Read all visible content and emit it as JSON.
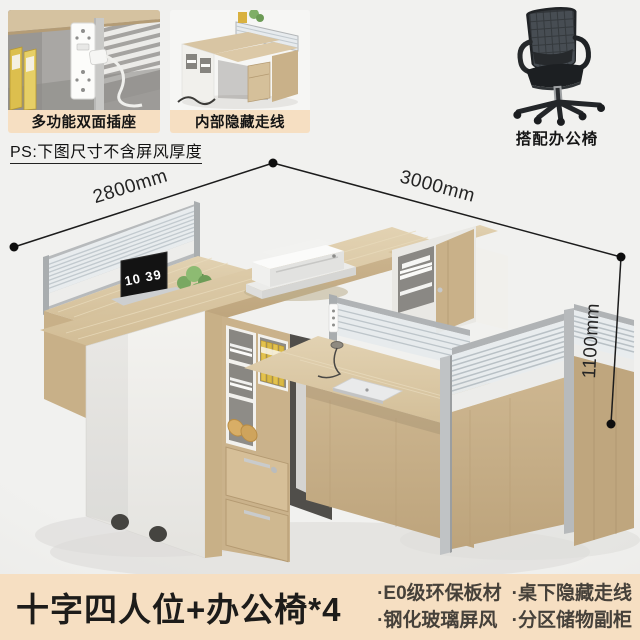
{
  "header": {
    "thumbnails": [
      {
        "label": "多功能双面插座"
      },
      {
        "label": "内部隐藏走线"
      }
    ],
    "chair_label": "搭配办公椅",
    "note": "PS:下图尺寸不含屏风厚度"
  },
  "diagram": {
    "dimensions": {
      "left": "2800mm",
      "right": "3000mm",
      "height": "1100mm"
    },
    "laptop_clock": "10 39"
  },
  "footer": {
    "title": "十字四人位+办公椅*4",
    "features": [
      "·E0级环保板材",
      "·桌下隐藏走线",
      "·钢化玻璃屏风",
      "·分区储物副柜"
    ]
  },
  "colors": {
    "background": "#eeeeec",
    "banner_bg": "#f6dfc2",
    "label_bg": "#f6dfc2",
    "wood": "#d6c3a0",
    "wood_dark": "#c2a980",
    "panel_white": "#f1f0ec",
    "frame_silver": "#b3b6b8",
    "glass": "#e8ecee",
    "binder_yellow": "#e0c253",
    "text_dark": "#1d1c1a",
    "feature_text": "#46413a"
  }
}
